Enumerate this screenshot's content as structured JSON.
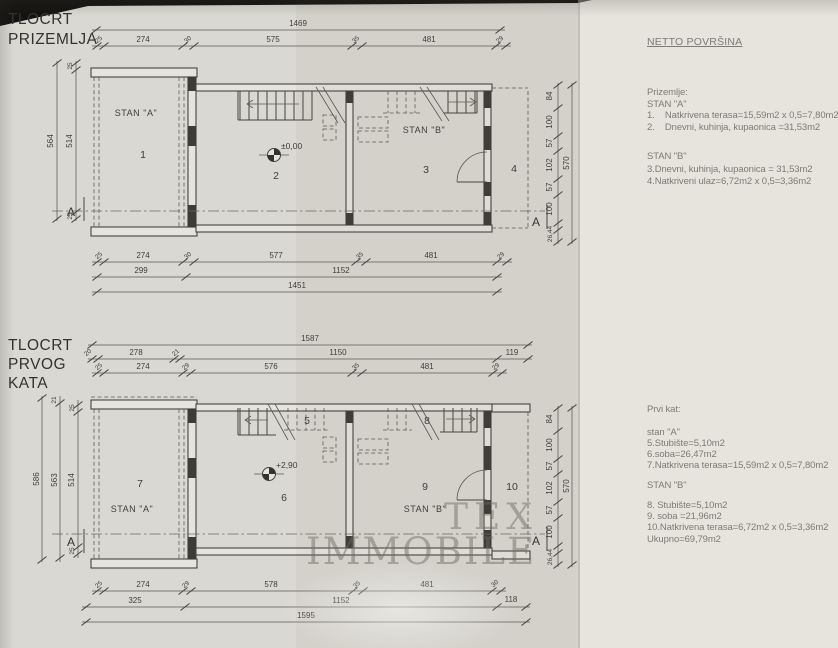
{
  "plan1": {
    "title_lines": [
      "TLOCRT",
      "PRIZEMLJA"
    ],
    "dims": {
      "top_overall": "1469",
      "top_segments": [
        "25",
        "274",
        "30",
        "575",
        "35",
        "481",
        "29"
      ],
      "bottom_segments": [
        "25",
        "274",
        "30",
        "577",
        "35",
        "481",
        "29"
      ],
      "bottom_row2": [
        "299",
        "1152"
      ],
      "bottom_overall": "1451",
      "left_outer": "564",
      "left_inner": "514",
      "left_tick_top": "25",
      "left_tick_bottom": "25",
      "right_segments": [
        "84",
        "100",
        "57",
        "102",
        "57",
        "100"
      ],
      "right_small": "26,44",
      "right_overall": "570"
    },
    "labels": {
      "stan_a": "STAN \"A\"",
      "stan_b": "STAN \"B\"",
      "room1": "1",
      "room2": "2",
      "room3": "3",
      "room4": "4",
      "elevation": "±0,00",
      "section": "A"
    }
  },
  "plan2": {
    "title_lines": [
      "TLOCRT",
      "PRVOG",
      "KATA"
    ],
    "dims": {
      "top_overall": "1587",
      "top_row2": [
        "20",
        "278",
        "21",
        "1150",
        "119"
      ],
      "top_segments": [
        "25",
        "274",
        "29",
        "576",
        "35",
        "481",
        "29"
      ],
      "bottom_segments": [
        "25",
        "274",
        "29",
        "578",
        "35",
        "481",
        "30"
      ],
      "bottom_row2": [
        "325",
        "1152",
        "118"
      ],
      "bottom_overall": "1595",
      "left_l1": "586",
      "left_l2": "563",
      "left_l3": "514",
      "left_tick_a": "21",
      "left_tick_b": "25",
      "left_tick_c": "25",
      "right_segments": [
        "84",
        "100",
        "57",
        "102",
        "57",
        "100"
      ],
      "right_small": "26,44",
      "right_overall": "570"
    },
    "labels": {
      "stan_a": "STAN \"A\"",
      "stan_b": "STAN \"B\"",
      "room5": "5",
      "room6": "6",
      "room7": "7",
      "room8": "8",
      "room9": "9",
      "room10": "10",
      "elevation": "+2,90",
      "section": "A"
    }
  },
  "notes": {
    "heading": "NETTO POVRŠINA",
    "ground": {
      "title": "Prizemlje:",
      "stan_a": "STAN \"A\"",
      "item1": "1.    Natkrivena terasa=15,59m2 x 0,5=7,80m2",
      "item2": "2.    Dnevni, kuhinja, kupaonica =31,53m2",
      "stan_b": "STAN \"B\"",
      "item3": "3.Dnevni, kuhinja, kupaonica = 31,53m2",
      "item4": "4.Natkriveni ulaz=6,72m2 x 0,5=3,36m2"
    },
    "first": {
      "title": "Prvi kat:",
      "stan_a": "stan \"A\"",
      "item5": "5.Stubište=5,10m2",
      "item6": "6.soba=26,47m2",
      "item7": "7.Natkrivena terasa=15,59m2 x 0,5=7,80m2",
      "stan_b": "STAN \"B\"",
      "item8": "8. Stubište=5,10m2",
      "item9": "9. soba =21,96m2",
      "item10": "10.Natkrivena terasa=6,72m2 x 0,5=3,36m2",
      "total": "Ukupno=69,79m2"
    }
  },
  "watermark": {
    "line1": "TEX",
    "line2": "IMMOBILE"
  },
  "colors": {
    "paper": "#dad8d2",
    "ink": "#45443f",
    "watermark": "#8a867d"
  }
}
